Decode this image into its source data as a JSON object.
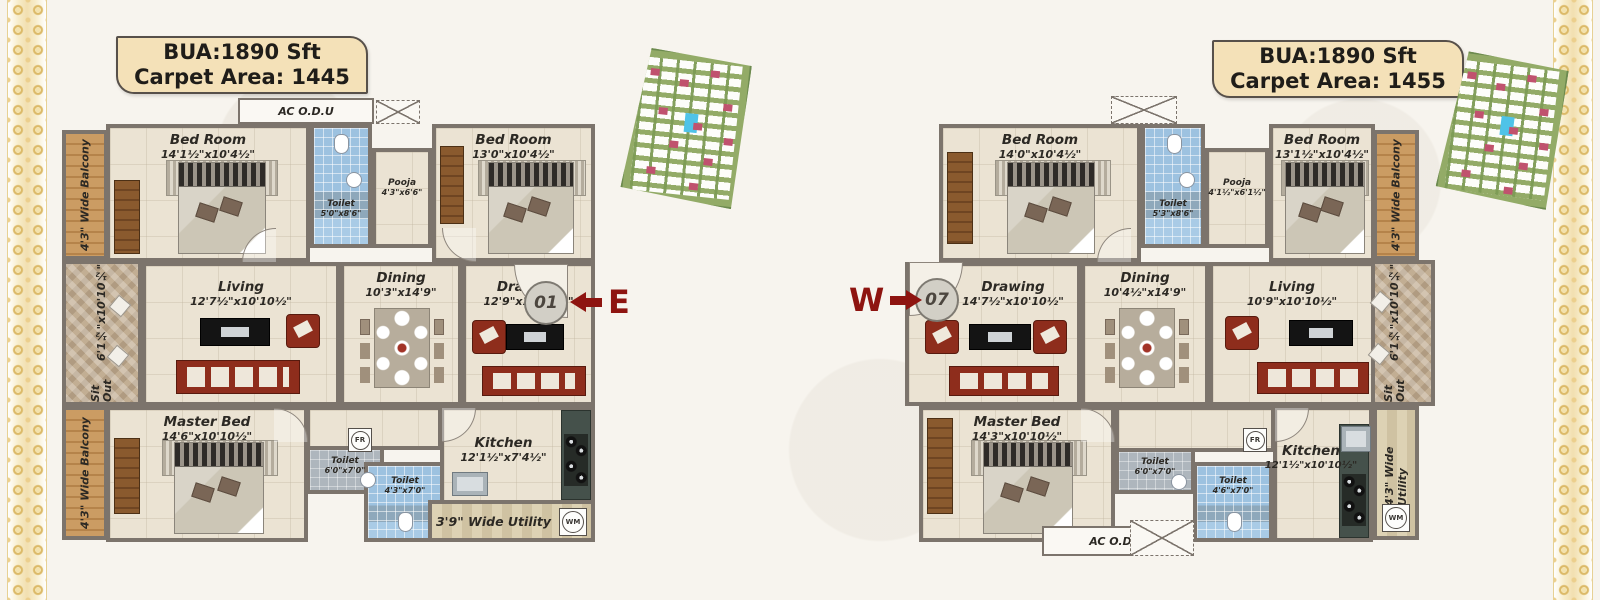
{
  "palette": {
    "wall": "#7c746c",
    "floor": "#ebe3d3",
    "toilet_blue": "#a3c6e2",
    "balcony_wood": "#bb8a50",
    "sofa_red": "#8e2d1c",
    "title_tan": "#f4e1b8",
    "direction_maroon": "#8e1410",
    "lace_gold": "#dcba69"
  },
  "plans": [
    {
      "title_line1": "BUA:1890 Sft",
      "title_line2": "Carpet Area: 1445",
      "unit_number": "01",
      "direction": "E",
      "ac_odu": "AC O.D.U",
      "balcony_top": "4'3\" Wide Balcony",
      "balcony_bottom": "4'3\" Wide Balcony",
      "sitout_name": "Sit Out",
      "sitout_dim": "6'1½\"x10'10½\"",
      "bedroom1_name": "Bed Room",
      "bedroom1_dim": "14'1½\"x10'4½\"",
      "toilet1_name": "Toilet",
      "toilet1_dim": "5'0\"x8'6\"",
      "pooja_name": "Pooja",
      "pooja_dim": "4'3\"x6'6\"",
      "bedroom2_name": "Bed Room",
      "bedroom2_dim": "13'0\"x10'4½\"",
      "living_name": "Living",
      "living_dim": "12'7½\"x10'10½\"",
      "dining_name": "Dining",
      "dining_dim": "10'3\"x14'9\"",
      "drawing_name": "Drawing",
      "drawing_dim": "12'9\"x10'10½\"",
      "master_name": "Master Bed",
      "master_dim": "14'6\"x10'10½\"",
      "toilet2_name": "Toilet",
      "toilet2_dim": "6'0\"x7'0\"",
      "toilet3_name": "Toilet",
      "toilet3_dim": "4'3\"x7'0\"",
      "kitchen_name": "Kitchen",
      "kitchen_dim": "12'1½\"x7'4½\"",
      "utility_label": "3'9\" Wide Utility",
      "fr": "FR",
      "wm": "WM"
    },
    {
      "title_line1": "BUA:1890 Sft",
      "title_line2": "Carpet Area: 1455",
      "unit_number": "07",
      "direction": "W",
      "ac_odu": "AC O.D.U",
      "balcony_top": "4'3\" Wide Balcony",
      "utility_side": "4'3\" Wide Utility",
      "sitout_name": "Sit Out",
      "sitout_dim": "6'1½\"x10'10½\"",
      "bedroom1_name": "Bed Room",
      "bedroom1_dim": "14'0\"x10'4½\"",
      "toilet1_name": "Toilet",
      "toilet1_dim": "5'3\"x8'6\"",
      "pooja_name": "Pooja",
      "pooja_dim": "4'1½\"x6'1½\"",
      "bedroom2_name": "Bed Room",
      "bedroom2_dim": "13'1½\"x10'4½\"",
      "drawing_name": "Drawing",
      "drawing_dim": "14'7½\"x10'10½\"",
      "dining_name": "Dining",
      "dining_dim": "10'4½\"x14'9\"",
      "living_name": "Living",
      "living_dim": "10'9\"x10'10½\"",
      "master_name": "Master Bed",
      "master_dim": "14'3\"x10'10½\"",
      "toilet2_name": "Toilet",
      "toilet2_dim": "6'0\"x7'0\"",
      "toilet3_name": "Toilet",
      "toilet3_dim": "4'6\"x7'0\"",
      "kitchen_name": "Kitchen",
      "kitchen_dim": "12'1½\"x10'10½\"",
      "fr": "FR",
      "wm": "WM"
    }
  ]
}
